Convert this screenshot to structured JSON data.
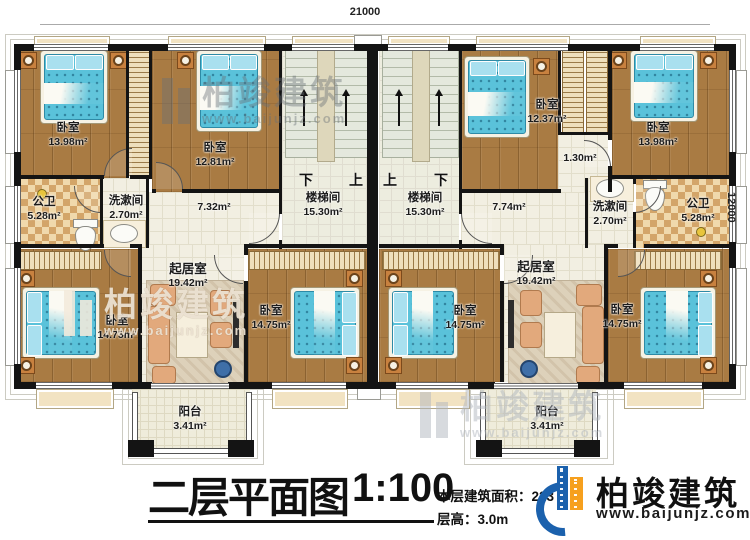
{
  "plan": {
    "dimensions": {
      "top": "21000",
      "right": "12000"
    },
    "rooms": {
      "bedroom_tl": {
        "name": "卧室",
        "area": "13.98m²"
      },
      "bedroom_tl2": {
        "name": "卧室",
        "area": "12.81m²"
      },
      "bedroom_tr1": {
        "name": "卧室",
        "area": "12.37m²"
      },
      "bedroom_tr2": {
        "name": "卧室",
        "area": "13.98m²"
      },
      "bedroom_bl": {
        "name": "卧室",
        "area": "14.75m²"
      },
      "bedroom_bml": {
        "name": "卧室",
        "area": "14.75m²"
      },
      "bedroom_bmr": {
        "name": "卧室",
        "area": "14.75m²"
      },
      "bedroom_br": {
        "name": "卧室",
        "area": "14.75m²"
      },
      "living_left": {
        "name": "起居室",
        "area": "19.42m²"
      },
      "living_right": {
        "name": "起居室",
        "area": "19.42m²"
      },
      "bath_left": {
        "name": "公卫",
        "area": "5.28m²"
      },
      "bath_right": {
        "name": "公卫",
        "area": "5.28m²"
      },
      "wash_left": {
        "name": "洗漱间",
        "area": "2.70m²"
      },
      "wash_right": {
        "name": "洗漱间",
        "area": "2.70m²"
      },
      "stair_left": {
        "name": "楼梯间",
        "area": "15.30m²",
        "mark_left": "下",
        "mark_right": "上"
      },
      "stair_right": {
        "name": "楼梯间",
        "area": "15.30m²",
        "mark_left": "上",
        "mark_right": "下"
      },
      "hall_left": {
        "area": "7.32m²"
      },
      "hall_right": {
        "area": "7.74m²"
      },
      "closet_right": {
        "area": "1.30m²"
      },
      "balcony_left": {
        "name": "阳台",
        "area": "3.41m²"
      },
      "balcony_right": {
        "name": "阳台",
        "area": "3.41m²"
      }
    }
  },
  "titleblock": {
    "title": "二层平面图",
    "scale": "1:100",
    "area_label": "本层建筑面积：223",
    "floor_height": "层高：3.0m"
  },
  "brand": {
    "name": "柏竣建筑",
    "url": "www.baijunjz.com"
  },
  "watermark": {
    "name": "柏竣建筑",
    "url": "www.baijunjz.com"
  },
  "icons": {
    "brand_logo": "building-logo-icon",
    "watermark_logo": "building-logo-icon",
    "stair_arrow": "up-arrow-icon"
  },
  "colors": {
    "wall": "#141414",
    "wood_floor": "#a97b43",
    "tile_floor": "#f2efe2",
    "checker_tile": "#d3a569",
    "bed": "#5ac2da",
    "accent_wood": "#c8813f",
    "brand_blue": "#1b61ad",
    "brand_orange": "#f6a01e"
  }
}
